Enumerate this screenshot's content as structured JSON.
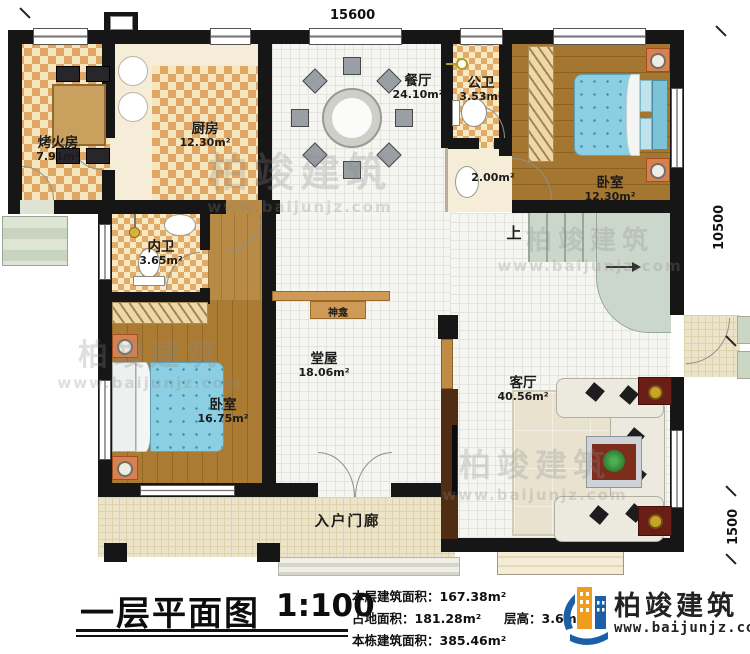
{
  "dimensions": {
    "width_top": "15600",
    "height_right": "10500",
    "porch_right": "1500"
  },
  "rooms": {
    "kaohuofang": {
      "name": "烤火房",
      "area": "7.91m²"
    },
    "kitchen": {
      "name": "厨房",
      "area": "12.30m²"
    },
    "dining": {
      "name": "餐厅",
      "area": "24.10m²"
    },
    "public_bath": {
      "name": "公卫",
      "area": "3.53m²"
    },
    "washroom": {
      "area": "2.00m²"
    },
    "bedroom_top": {
      "name": "卧室",
      "area": "12.30m²"
    },
    "inner_bath": {
      "name": "内卫",
      "area": "3.65m²"
    },
    "bedroom_left": {
      "name": "卧室",
      "area": "16.75m²"
    },
    "hall": {
      "name": "堂屋",
      "area": "18.06m²"
    },
    "living": {
      "name": "客厅",
      "area": "40.56m²"
    },
    "shrine": {
      "name": "神龛"
    },
    "entry_porch": {
      "name": "入户门廊"
    },
    "stairs": {
      "up_label": "上"
    }
  },
  "title_block": {
    "title": "一层平面图",
    "scale": "1:100",
    "stats": {
      "line1_label": "本层建筑面积：",
      "line1_value": "167.38m²",
      "line2a_label": "占地面积：",
      "line2a_value": "181.28m²",
      "line2b_label": "层高：",
      "line2b_value": "3.6m",
      "line3_label": "本栋建筑面积：",
      "line3_value": "385.46m²"
    }
  },
  "logo": {
    "name": "柏竣建筑",
    "website": "www.baijunjz.com"
  },
  "watermark": {
    "name": "柏竣建筑",
    "website": "www.baijunjz.com"
  }
}
